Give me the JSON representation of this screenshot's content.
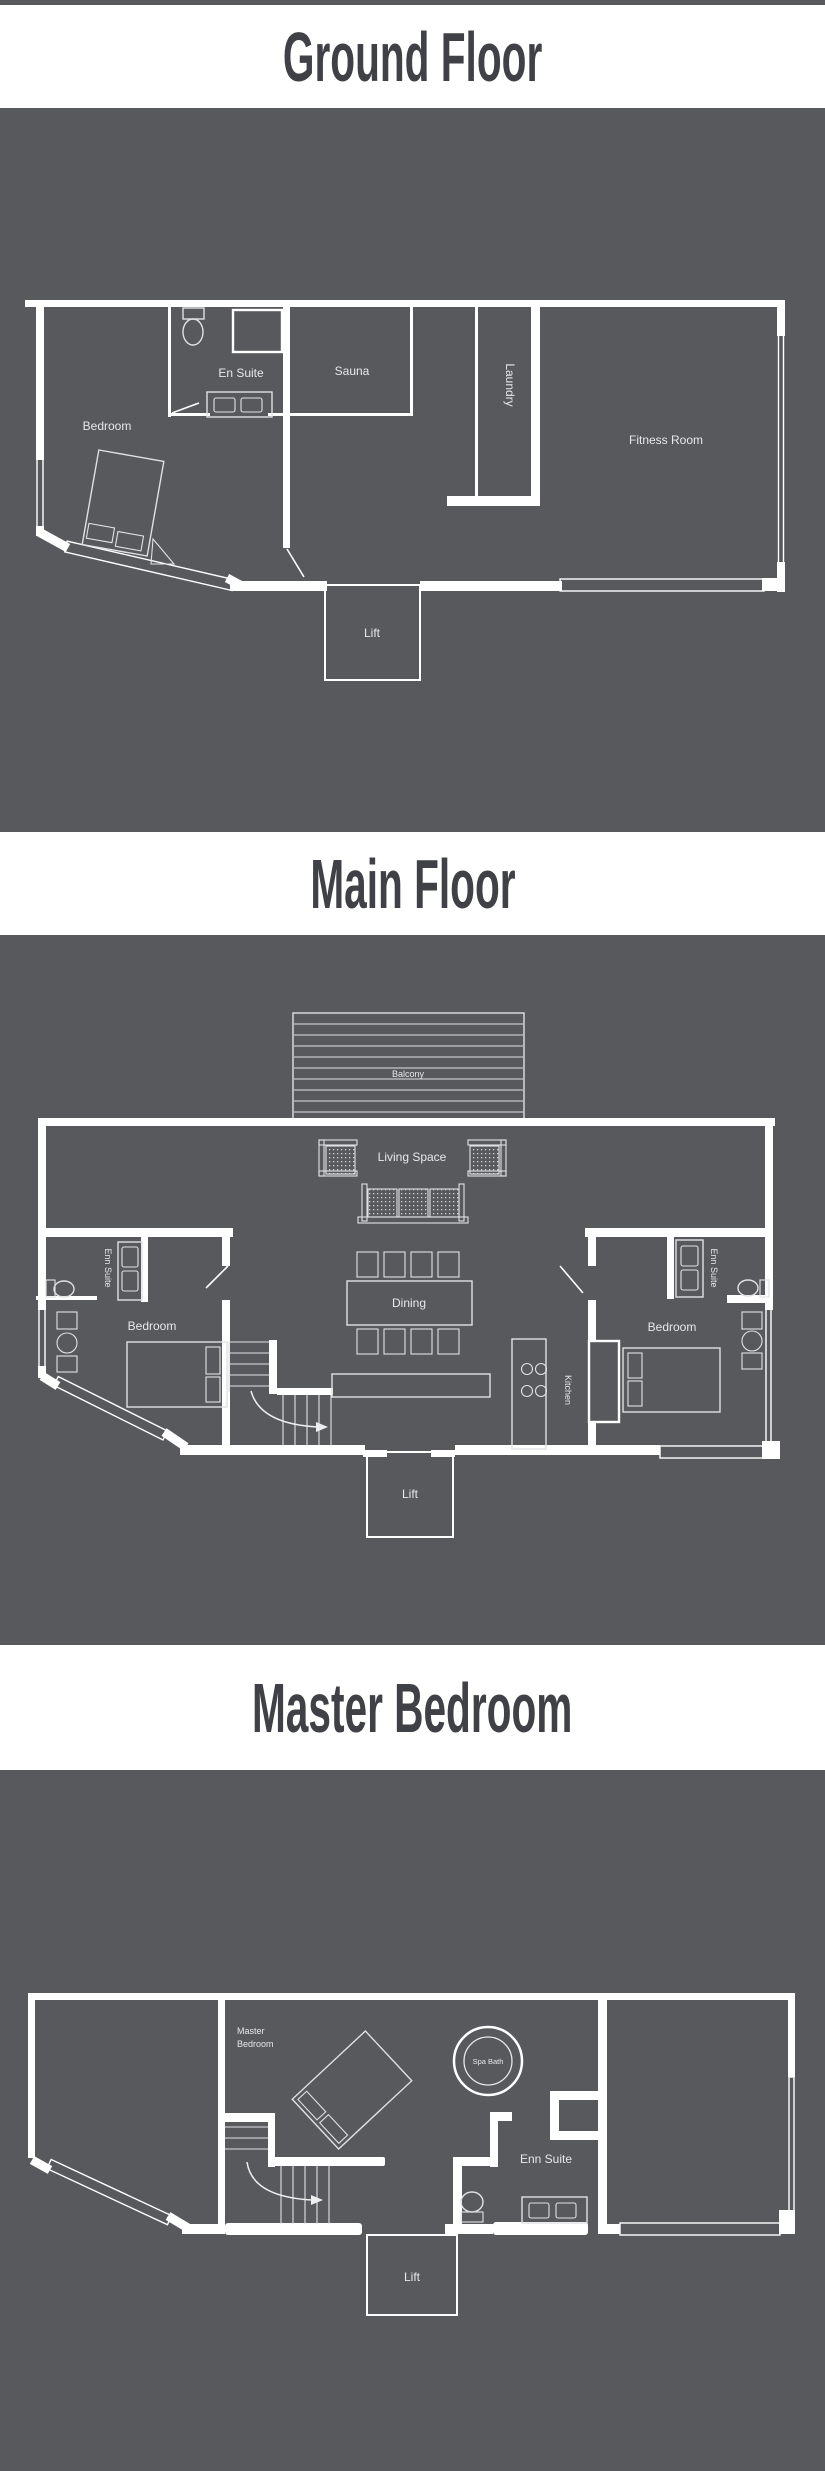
{
  "page": {
    "background": "#58595c",
    "band_color": "#ffffff",
    "title_color": "#3f4146",
    "wall_color": "#ffffff",
    "label_color": "#e7e8ea"
  },
  "sections": {
    "ground": {
      "title": "Ground Floor",
      "rooms": {
        "bedroom": "Bedroom",
        "en_suite": "En Suite",
        "sauna": "Sauna",
        "laundry": "Laundry",
        "fitness_room": "Fitness Room",
        "lift": "Lift"
      }
    },
    "main": {
      "title": "Main Floor",
      "rooms": {
        "balcony": "Balcony",
        "living_space": "Living Space",
        "en_suite_left": "Enn Suite",
        "bedroom_left": "Bedroom",
        "dining": "Dining",
        "kitchen": "Kitchen",
        "en_suite_right": "Enn Suite",
        "bedroom_right": "Bedroom",
        "lift": "Lift"
      }
    },
    "master": {
      "title": "Master Bedroom",
      "rooms": {
        "master_line1": "Master",
        "master_line2": "Bedroom",
        "spa_bath": "Spa Bath",
        "en_suite": "Enn Suite",
        "lift": "Lift"
      }
    }
  }
}
